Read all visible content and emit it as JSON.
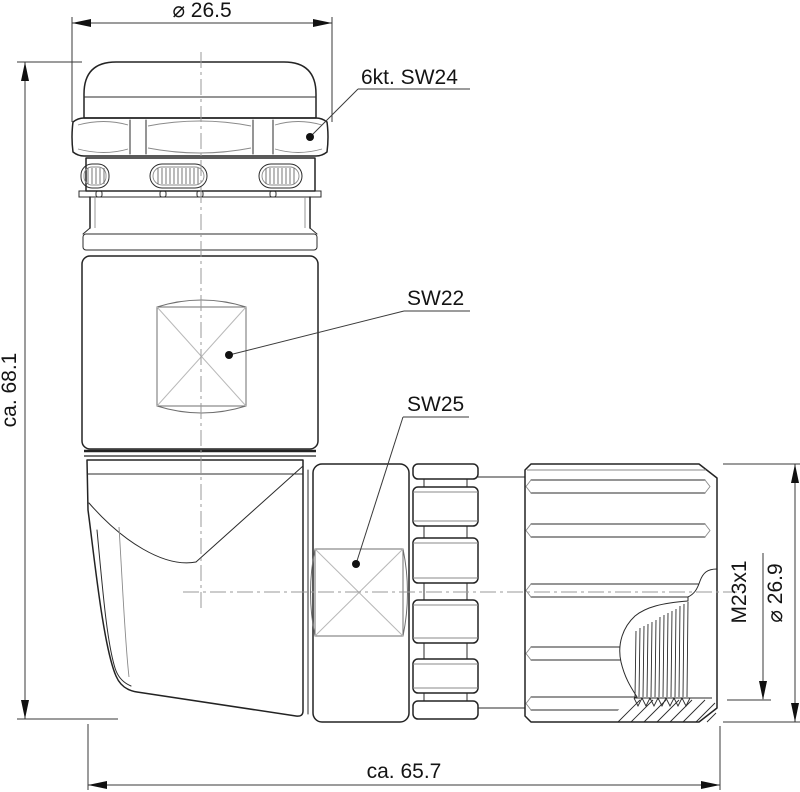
{
  "drawing": {
    "dimensions": {
      "top_diameter": "⌀ 26.5",
      "overall_height": "ca. 68.1",
      "overall_length": "ca. 65.7",
      "thread_spec": "M23x1",
      "end_diameter": "⌀ 26.9"
    },
    "callouts": {
      "hex_nut": "6kt. SW24",
      "body_wrench_flat": "SW22",
      "coupling_wrench_flat": "SW25"
    },
    "colors": {
      "background": "#ffffff",
      "outline": "#232323",
      "dimension_line": "#3a3a3a",
      "centerline": "#9a9a9a",
      "thin_detail": "#8a8a8a"
    }
  }
}
